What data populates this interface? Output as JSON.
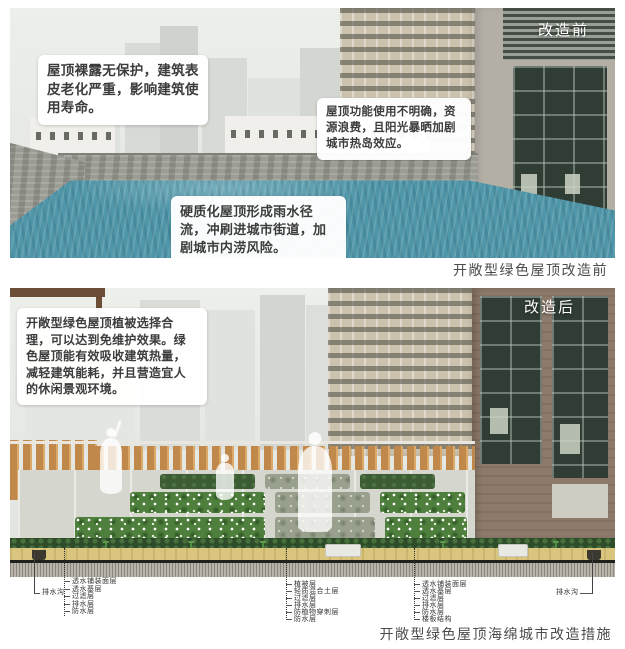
{
  "colors": {
    "roof-teal": "#4f96a9",
    "fence-wood": "#c0884a",
    "bed-green": "#4e7f3d",
    "bed-sage": "#99a18e",
    "soil-tan": "#d9c57e",
    "callout-text": "#3c3c3c"
  },
  "before": {
    "tag": "改造前",
    "callout_roof_exposed": "屋顶裸露无保护，建筑表皮老化严重，影响建筑使用寿命。",
    "callout_heat_island": "屋顶功能使用不明确，资源浪费，且阳光暴晒加剧城市热岛效应。",
    "callout_runoff": "硬质化屋顶形成雨水径流，冲刷进城市街道，加剧城市内涝风险。",
    "caption": "开敞型绿色屋顶改造前"
  },
  "after": {
    "tag": "改造后",
    "callout_benefits": "开敞型绿色屋顶植被选择合理，可以达到免维护效果。绿色屋顶能有效吸收建筑热量，减轻建筑能耗，并且营造宜人的休闲景观环境。",
    "caption": "开敞型绿色屋顶海绵城市改造措施"
  },
  "section": {
    "drain_left": "排水沟",
    "drain_right": "排水沟",
    "left_layers": [
      "透水铺装面层",
      "透水基层",
      "过滤层",
      "排水层",
      "防水层"
    ],
    "mid_layers": [
      "植被层",
      "轻质混合土层",
      "过滤层",
      "排水层",
      "防植物穿刺层",
      "防水层"
    ],
    "right_layers": [
      "透水铺装面层",
      "透水基层",
      "过滤层",
      "排水层",
      "防水层",
      "楼板结构"
    ]
  }
}
